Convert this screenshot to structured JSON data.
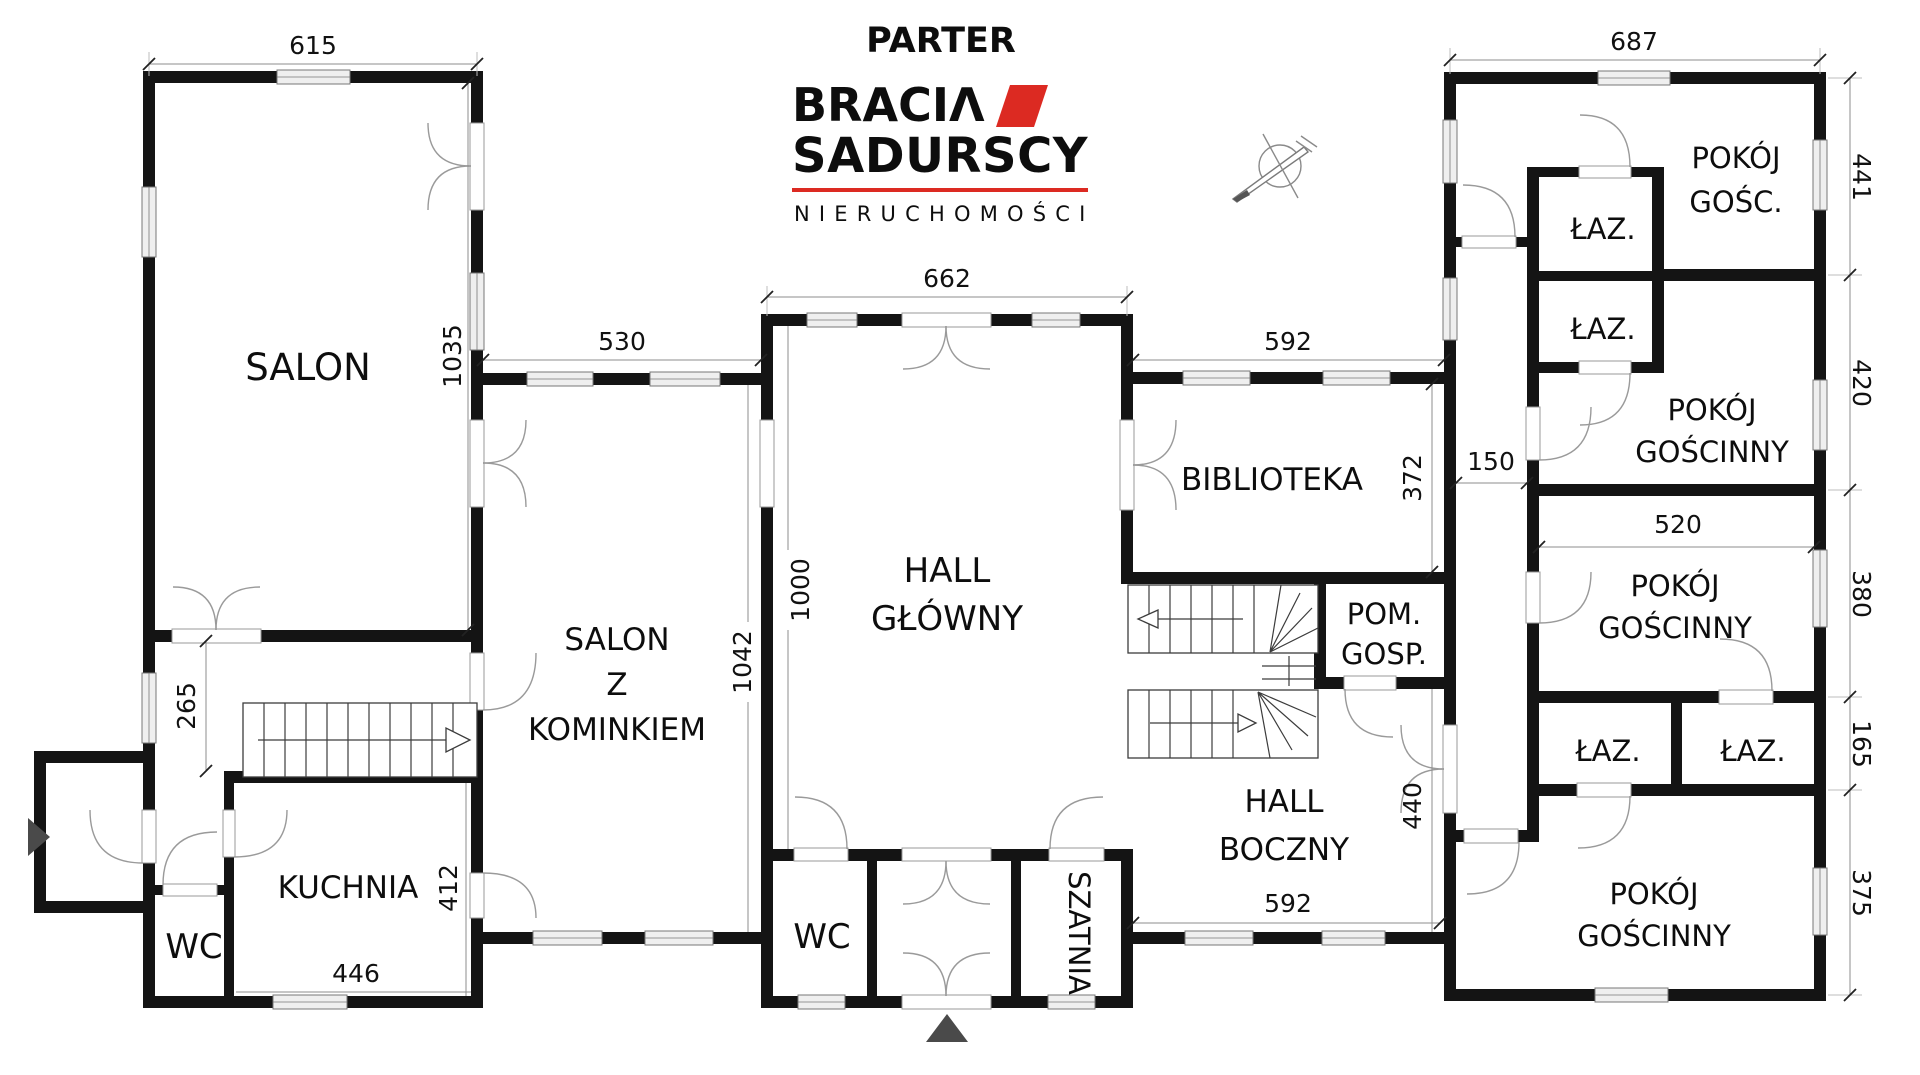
{
  "page": {
    "title": "PARTER"
  },
  "logo": {
    "brand_prefix": "BRACI",
    "brand_a": "Λ",
    "brand_line2": "SADURSCY",
    "tagline": "NIERUCHOMOŚCI"
  },
  "colors": {
    "wall": "#141414",
    "accent_red": "#dc2a22",
    "entrance_arrow": "#4a4a4a"
  },
  "rooms": {
    "salon": "SALON",
    "kuchnia": "KUCHNIA",
    "wc_left": "WC",
    "szk_1": "SALON",
    "szk_2": "Z",
    "szk_3": "KOMINKIEM",
    "hall_glowny_1": "HALL",
    "hall_glowny_2": "GŁÓWNY",
    "wc_center": "WC",
    "szatnia": "SZATNIA",
    "biblioteka": "BIBLIOTEKA",
    "pom_gosp_1": "POM.",
    "pom_gosp_2": "GOSP.",
    "hall_boczny_1": "HALL",
    "hall_boczny_2": "BOCZNY",
    "pokoj_gosc_1": "POKÓJ",
    "pokoj_gosc_2": "GOŚC.",
    "laz_1": "ŁAZ.",
    "laz_2": "ŁAZ.",
    "laz_3": "ŁAZ.",
    "laz_4": "ŁAZ.",
    "pg420_1": "POKÓJ",
    "pg420_2": "GOŚCINNY",
    "pg380_1": "POKÓJ",
    "pg380_2": "GOŚCINNY",
    "pg375_1": "POKÓJ",
    "pg375_2": "GOŚCINNY"
  },
  "dims": {
    "w615": "615",
    "w687": "687",
    "w662": "662",
    "w530": "530",
    "w592_top": "592",
    "w592_bottom": "592",
    "h1035": "1035",
    "h265": "265",
    "h1000": "1000",
    "h1042": "1042",
    "h372": "372",
    "h440": "440",
    "h412": "412",
    "w446": "446",
    "w150": "150",
    "w520": "520",
    "h441": "441",
    "h420": "420",
    "h380": "380",
    "h165": "165",
    "h375": "375"
  }
}
